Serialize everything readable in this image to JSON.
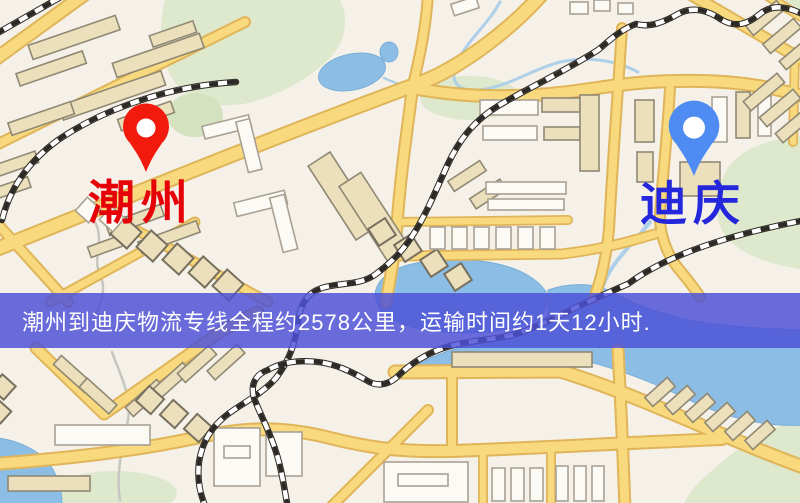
{
  "map": {
    "origin": {
      "label": "潮州",
      "label_color": "#e60008",
      "pin_color": "#f2190d",
      "pin_icon": "map-pin"
    },
    "destination": {
      "label": "迪庆",
      "label_color": "#2427dc",
      "pin_color": "#4e8cf3",
      "pin_icon": "map-pin"
    },
    "banner": {
      "text": "潮州到迪庆物流专线全程约2578公里，运输时间约1天12小时.",
      "distance_text": "全程约2578公里",
      "duration_text": "运输时间约1天12小时",
      "background_color": "#4d51d6",
      "text_color": "#ffffff"
    },
    "legend_colors": {
      "road": "#f8d97e",
      "park": "#dde8cd",
      "water": "#8cbde4",
      "railway": "#2d2a26",
      "building": "#ece0bc"
    }
  }
}
